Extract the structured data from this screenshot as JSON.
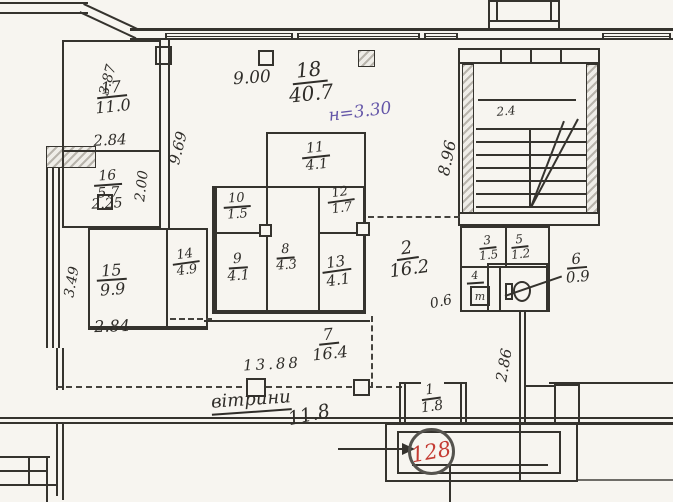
{
  "plan": {
    "type": "scanned apartment floor plan (BTI technical drawing)",
    "paper_color": "#f7f5f0",
    "ink_color": "#35332e",
    "red_color": "#c43b33",
    "purple_color": "#6456a8"
  },
  "rooms": [
    {
      "num": "17",
      "area": "11.0"
    },
    {
      "num": "16",
      "area": "5.7"
    },
    {
      "num": "15",
      "area": "9.9"
    },
    {
      "num": "14",
      "area": "4.9"
    },
    {
      "num": "18",
      "area": "40.7"
    },
    {
      "num": "11",
      "area": "4.1"
    },
    {
      "num": "10",
      "area": "1.5"
    },
    {
      "num": "12",
      "area": "1.7"
    },
    {
      "num": "9",
      "area": "4.1"
    },
    {
      "num": "8",
      "area": "4.3"
    },
    {
      "num": "13",
      "area": "4.1"
    },
    {
      "num": "7",
      "area": "16.4"
    },
    {
      "num": "2",
      "area": "16.2"
    },
    {
      "num": "3",
      "area": "1.5"
    },
    {
      "num": "5",
      "area": "1.2"
    },
    {
      "num": "4",
      "area": ""
    },
    {
      "num": "6",
      "area": "0.9"
    },
    {
      "num": "1",
      "area": "1.8"
    }
  ],
  "dimensions": {
    "d9_00": "9.00",
    "d3_87": "3.87",
    "d2_84a": "2.84",
    "d2_25": "2.25",
    "d2_00": "2.00",
    "d9_69": "9.69",
    "d3_49": "3.49",
    "d2_84b": "2.84",
    "d8_96": "8.96",
    "d2_4": "2.4",
    "d13_88": "13.88",
    "d11_8": "11.8",
    "d2_86": "2.86",
    "d0_6": "0.6"
  },
  "annotations": {
    "height_note": "н=3.30",
    "vitryny": "вітрини",
    "premise_number": "128",
    "toilet_mark": "т"
  }
}
